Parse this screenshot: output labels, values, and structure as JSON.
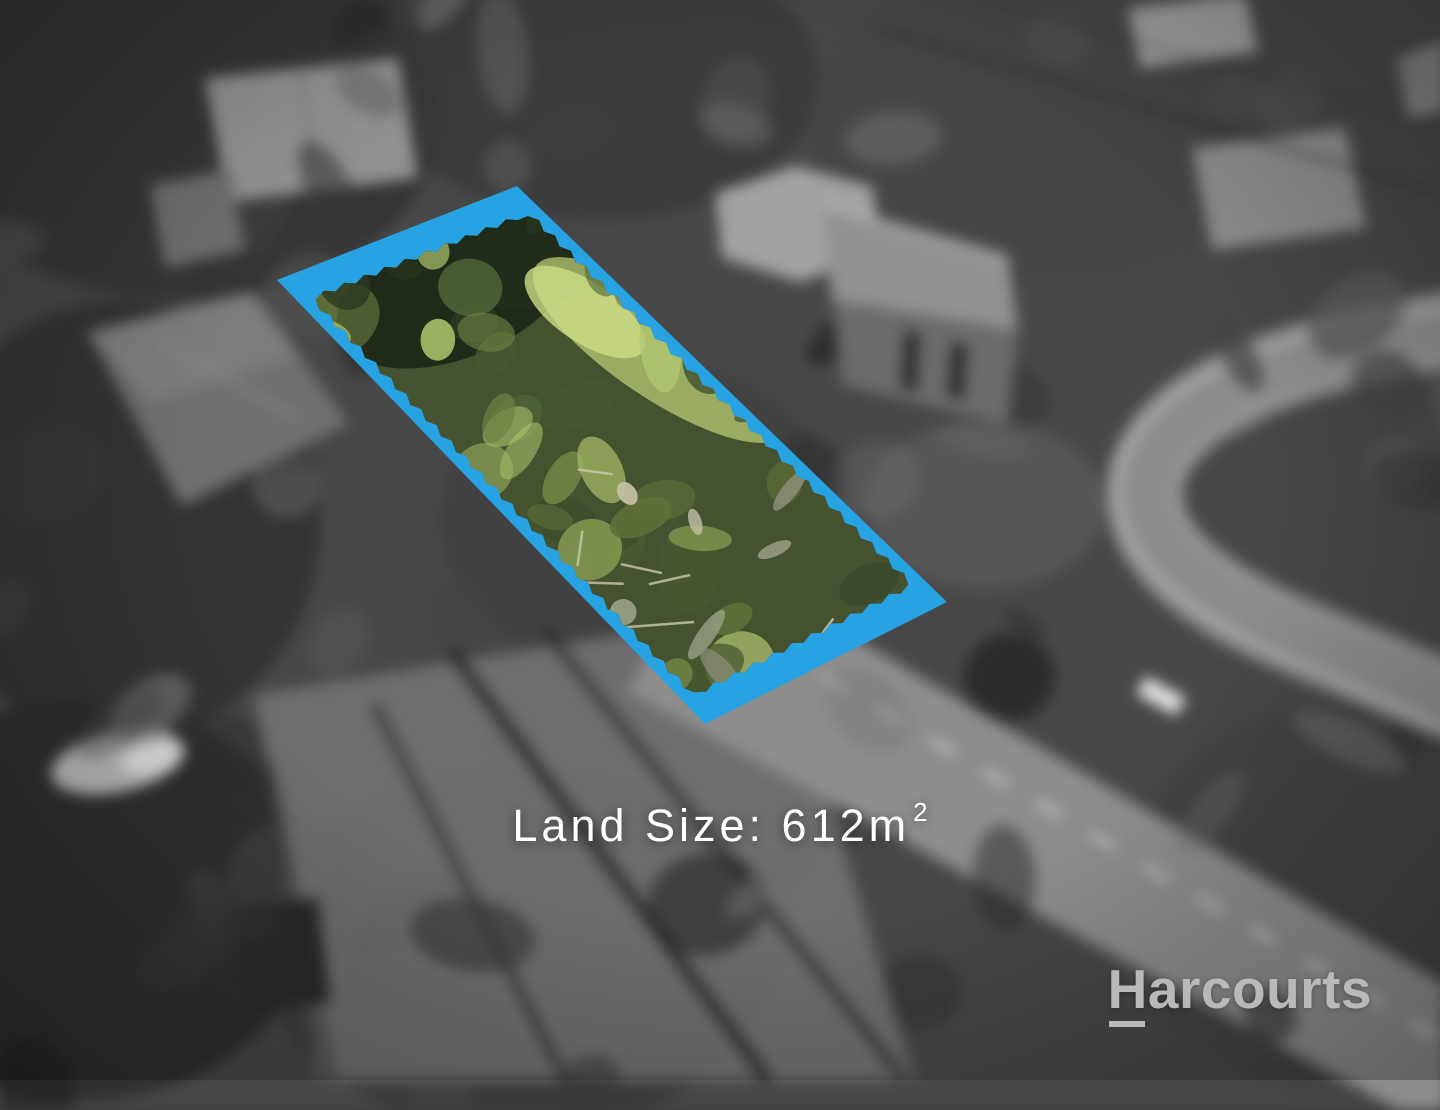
{
  "overlay": {
    "land_size_display": "Land Size: 612m²",
    "land_size_text": "Land Size: 612m",
    "land_size_superscript": "2"
  },
  "logo": {
    "name": "Harcourts",
    "first_letter": "H",
    "rest": "arcourts"
  },
  "colors": {
    "parcel_border": "#27A2E3",
    "land_size_text": "#FFFFFF",
    "logo_text": "#B9B9B9",
    "road_gray": "#8D8D8D",
    "vegetation_palette": [
      "#2b3a20",
      "#3a4a2a",
      "#4c5d33",
      "#5d7038",
      "#6e8243",
      "#7e934d",
      "#90a457",
      "#a3b764",
      "#b4c873",
      "#556a3b",
      "#475830"
    ],
    "deadwood_palette": [
      "#9aa084",
      "#b0b296",
      "#8e8f78",
      "#c2c0a4"
    ],
    "background_gray_palette": [
      "#232323",
      "#2d2d2d",
      "#383838",
      "#444444",
      "#505050",
      "#5c5c5c",
      "#6a6a6a"
    ],
    "background_highlight_palette": [
      "#747474",
      "#828282"
    ]
  },
  "parcel": {
    "outer_corners": [
      [
        517,
        186
      ],
      [
        947,
        602
      ],
      [
        705,
        724
      ],
      [
        277,
        280
      ]
    ],
    "inner_scale": 0.885,
    "inner_edge": "jagged"
  }
}
